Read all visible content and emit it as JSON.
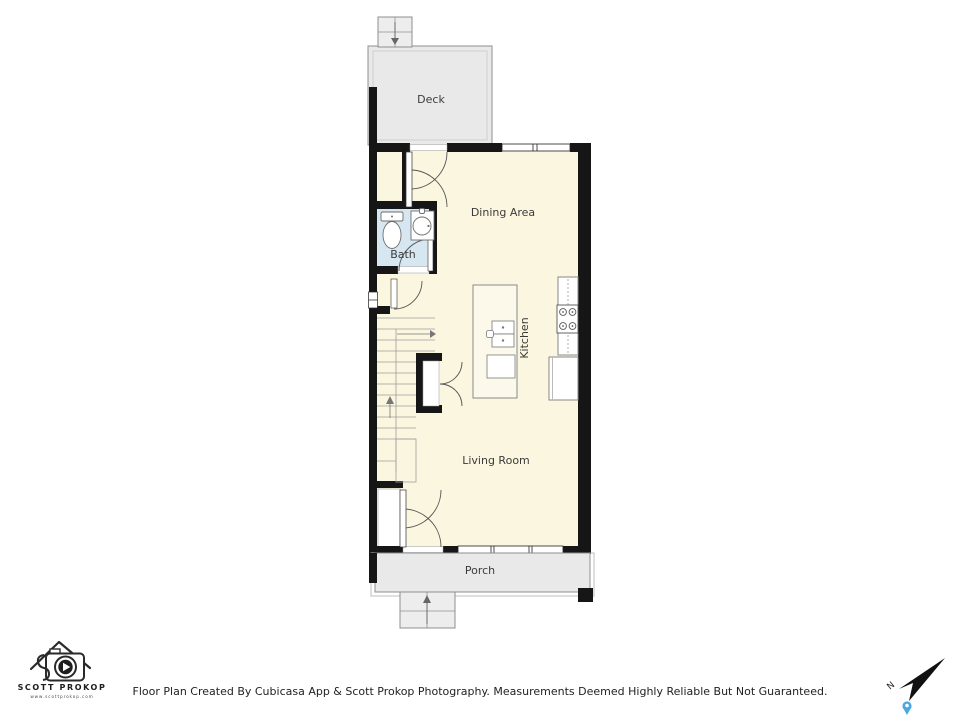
{
  "rooms": {
    "deck": "Deck",
    "dining": "Dining Area",
    "bath": "Bath",
    "kitchen": "Kitchen",
    "living": "Living Room",
    "porch": "Porch"
  },
  "footer": {
    "disclaimer": "Floor Plan Created By Cubicasa App & Scott Prokop Photography. Measurements Deemed Highly Reliable But Not Guaranteed."
  },
  "logo": {
    "name": "SCOTT PROKOP",
    "website": "www.scottprokop.com"
  },
  "compass": {
    "north_label": "N"
  },
  "icons": {
    "compass_arrow": "northeast-dart",
    "location_pin": "blue-teardrop-marker",
    "logo_mark": "house-roof-with-camera-play-button"
  },
  "colors": {
    "floor": "#FBF6DF",
    "bath_floor": "#D7E7F2",
    "deck_porch": "#E9E9E9",
    "wall": "#161616",
    "pin_blue": "#49A8E0"
  }
}
